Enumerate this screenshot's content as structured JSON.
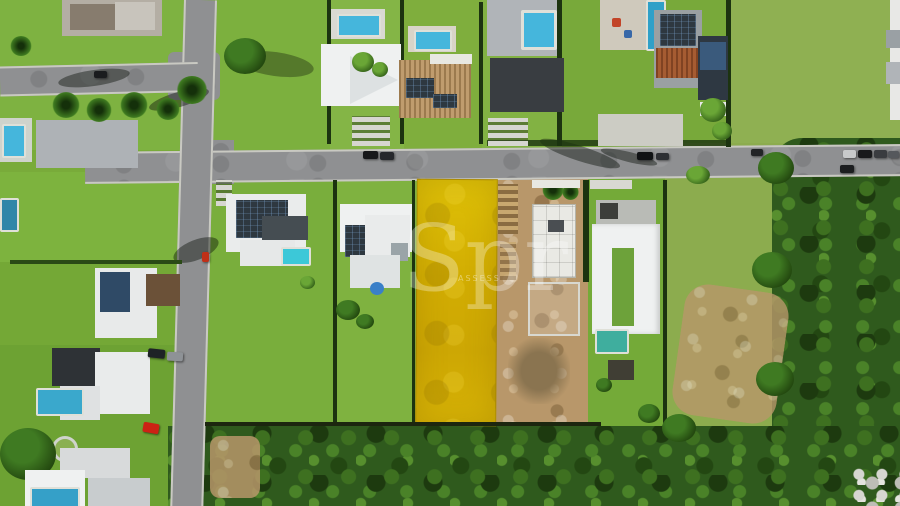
{
  "image": {
    "kind": "aerial-drone-photo",
    "description": "Top-down aerial photo of a residential condominium street; a vacant lot in the middle is highlighted in yellow (real-estate listing), flanked by a construction site, modern houses with pools and solar panels, roads, a green field and dense forest at the bottom.",
    "width": 900,
    "height": 506
  },
  "watermark": {
    "text": "Spr",
    "subtext": "ASSESS",
    "color": "#ffffff"
  },
  "palette": {
    "grass": "#79ab3a",
    "grass_light": "#84b546",
    "field": "#8cac4e",
    "forest": "#2f5a1d",
    "road": "#8f9092",
    "curb": "#c9c9c2",
    "dirt": "#b8976a",
    "yellow": "#d2ad02",
    "roof_white": "#eff1f1",
    "roof_gray": "#b0b4b8",
    "roof_dark": "#393d41",
    "roof_clay": "#c09c6e",
    "roof_terracotta": "#a65c32",
    "pool": "#45b6dc",
    "pool_teal": "#3fae9e",
    "car_red": "#cc2214",
    "hedge": "#1c3310"
  }
}
